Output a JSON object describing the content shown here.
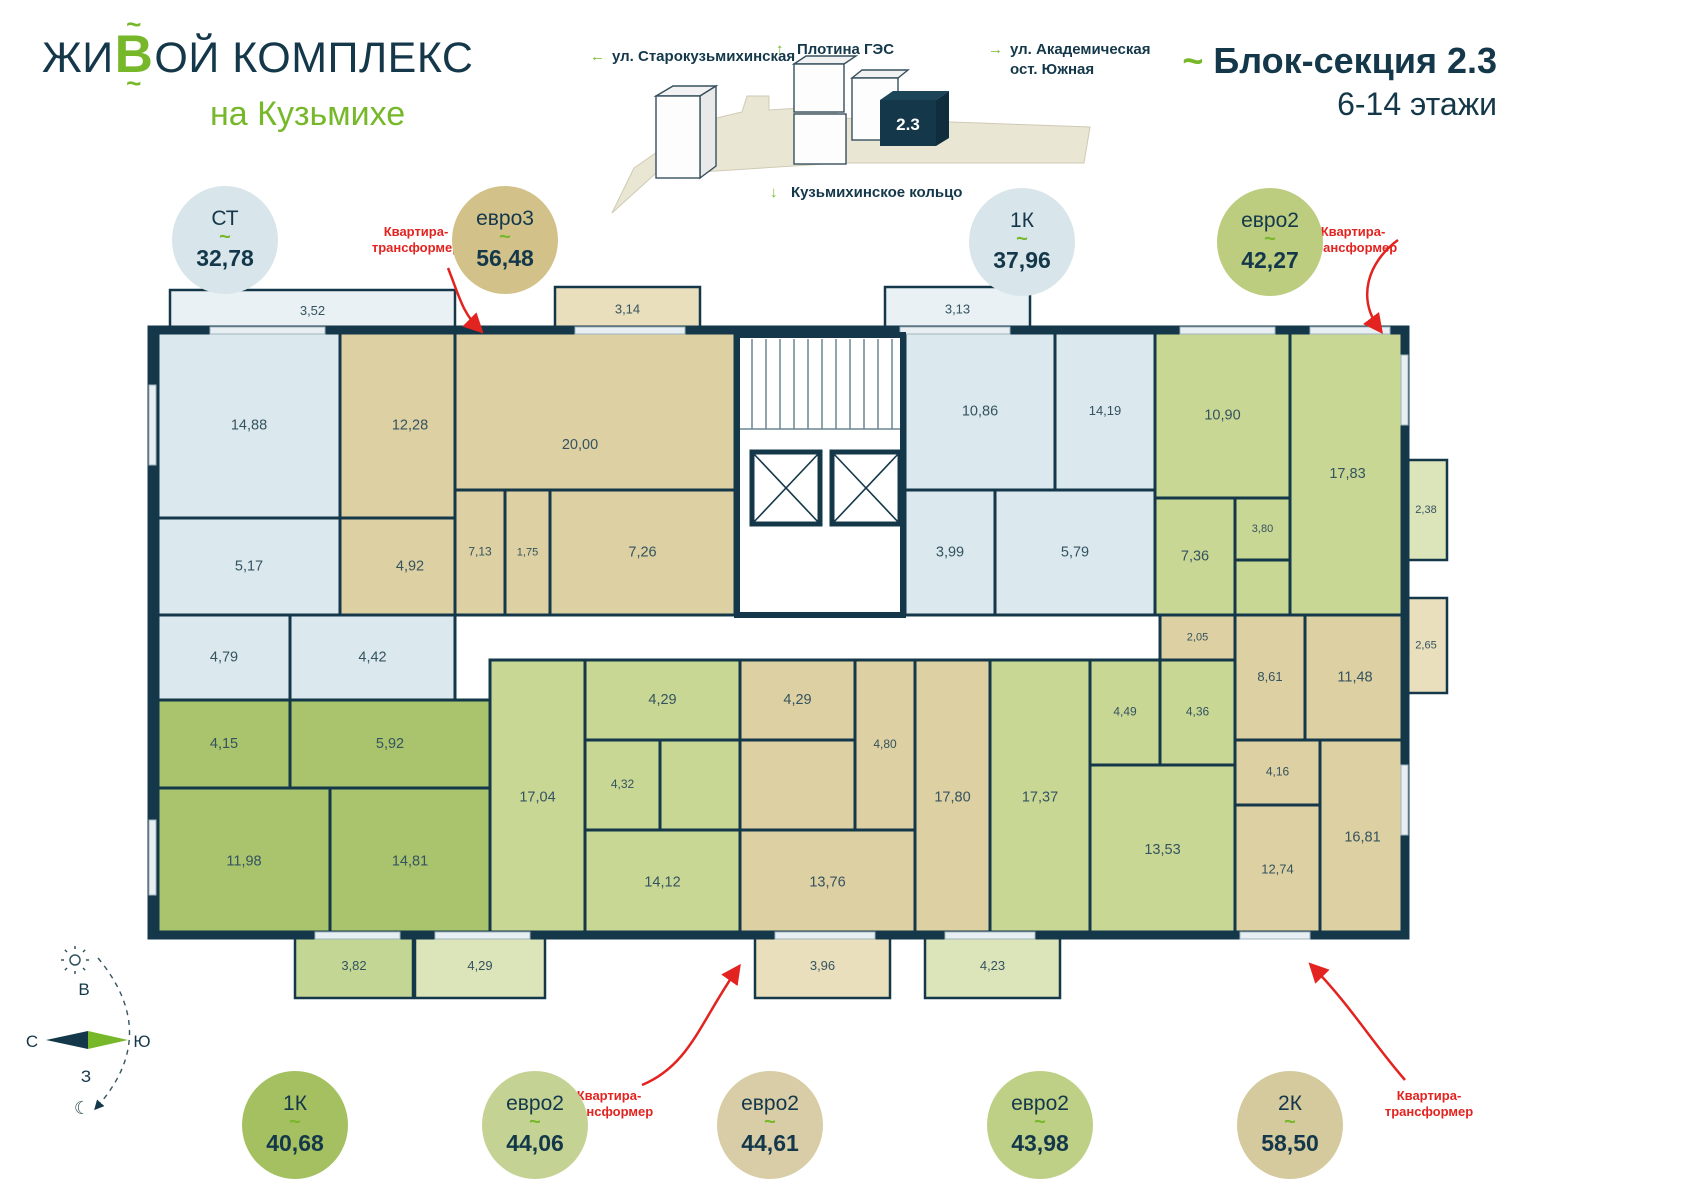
{
  "header": {
    "logo": {
      "part1": "жи",
      "accent": "В",
      "part2": "ой комплекс",
      "tilde": "~",
      "subtitle": "на Кузьмихе"
    },
    "title": {
      "tilde": "~",
      "line1": "Блок-секция 2.3",
      "line2": "6-14 этажи"
    },
    "site_map": {
      "block_label": "2.3",
      "labels": [
        {
          "arrow": "←",
          "line1": "ул. Старокузьмихинская",
          "line2": ""
        },
        {
          "arrow": "↑",
          "line1": "Плотина ГЭС",
          "line2": ""
        },
        {
          "arrow": "→",
          "line1": "ул. Академическая",
          "line2": "ост. Южная"
        },
        {
          "arrow": "↓",
          "line1": "Кузьмихинское кольцо",
          "line2": ""
        }
      ]
    }
  },
  "badges": {
    "tilde": "~",
    "transformer_label": "Квартира-трансформер",
    "list": [
      {
        "type": "СТ",
        "area": "32,78",
        "color": "#d8e6ec",
        "x": 225,
        "y": 240
      },
      {
        "type": "евро3",
        "area": "56,48",
        "color": "#d2c28a",
        "x": 505,
        "y": 240
      },
      {
        "type": "1К",
        "area": "37,96",
        "color": "#d8e6ec",
        "x": 1022,
        "y": 242
      },
      {
        "type": "евро2",
        "area": "42,27",
        "color": "#bccd80",
        "x": 1270,
        "y": 242
      },
      {
        "type": "1К",
        "area": "40,68",
        "color": "#a5c061",
        "x": 295,
        "y": 1125
      },
      {
        "type": "евро2",
        "area": "44,06",
        "color": "#c4d394",
        "x": 535,
        "y": 1125
      },
      {
        "type": "евро2",
        "area": "44,61",
        "color": "#d8cda6",
        "x": 770,
        "y": 1125
      },
      {
        "type": "евро2",
        "area": "43,98",
        "color": "#bed086",
        "x": 1040,
        "y": 1125
      },
      {
        "type": "2К",
        "area": "58,50",
        "color": "#d5c99e",
        "x": 1290,
        "y": 1125
      }
    ]
  },
  "compass": {
    "north": "С",
    "south": "Ю",
    "east": "В",
    "west": "З",
    "moon": "☾"
  },
  "floorplan": {
    "palette": {
      "wall": "#14384a",
      "label": "#35535f",
      "blue": "#dbe9ef",
      "blue_bal": "#e9f1f5",
      "tan": "#ddd0a2",
      "tan_bal": "#eadfbd",
      "green": "#c9d795",
      "green_bal": "#dce4ba",
      "dgreen": "#a9c46c",
      "dgreen_bal": "#c3d694"
    },
    "apartments": [
      {
        "type": "СТ",
        "total": "32,78",
        "color": "blue",
        "rooms": [
          {
            "l": "14,88",
            "x": 158,
            "y": 333,
            "w": 182,
            "h": 185
          },
          {
            "l": "5,17",
            "x": 158,
            "y": 518,
            "w": 182,
            "h": 97
          },
          {
            "l": "4,79",
            "x": 158,
            "y": 615,
            "w": 132,
            "h": 85
          },
          {
            "l": "4,42",
            "x": 290,
            "y": 615,
            "w": 165,
            "h": 85
          }
        ],
        "balconies": [
          {
            "l": "3,52",
            "x": 170,
            "y": 290,
            "w": 285,
            "h": 43
          }
        ]
      },
      {
        "type": "евро3",
        "total": "56,48",
        "color": "tan",
        "rooms": [
          {
            "l": "12,28",
            "x": 340,
            "y": 333,
            "w": 140,
            "h": 185
          },
          {
            "l": "4,92",
            "x": 340,
            "y": 518,
            "w": 140,
            "h": 97
          },
          {
            "l": "20,00",
            "x": 455,
            "y": 333,
            "w": 280,
            "h": 157,
            "lx": 580,
            "ly": 445
          },
          {
            "l": "7,13",
            "x": 455,
            "y": 490,
            "w": 50,
            "h": 125,
            "fs": 12
          },
          {
            "l": "1,75",
            "x": 505,
            "y": 490,
            "w": 45,
            "h": 125,
            "fs": 11
          },
          {
            "l": "7,26",
            "x": 550,
            "y": 490,
            "w": 185,
            "h": 125
          }
        ],
        "balconies": [
          {
            "l": "3,14",
            "x": 555,
            "y": 287,
            "w": 145,
            "h": 46
          }
        ]
      },
      {
        "type": "1К",
        "total": "37,96",
        "color": "blue",
        "rooms": [
          {
            "l": "10,86",
            "x": 905,
            "y": 333,
            "w": 150,
            "h": 157
          },
          {
            "l": "14,19",
            "x": 1055,
            "y": 333,
            "w": 100,
            "h": 157,
            "fs": 13
          },
          {
            "l": "3,99",
            "x": 905,
            "y": 490,
            "w": 90,
            "h": 125
          },
          {
            "l": "5,79",
            "x": 995,
            "y": 490,
            "w": 160,
            "h": 125
          }
        ],
        "balconies": [
          {
            "l": "3,13",
            "x": 885,
            "y": 287,
            "w": 145,
            "h": 46
          }
        ]
      },
      {
        "type": "евро2",
        "total": "42,27",
        "color": "green",
        "rooms": [
          {
            "l": "10,90",
            "x": 1155,
            "y": 333,
            "w": 135,
            "h": 165
          },
          {
            "l": "17,83",
            "x": 1290,
            "y": 333,
            "w": 115,
            "h": 282
          },
          {
            "l": "7,36",
            "x": 1155,
            "y": 498,
            "w": 80,
            "h": 117
          },
          {
            "l": "3,80",
            "x": 1235,
            "y": 498,
            "w": 55,
            "h": 62,
            "fs": 11
          },
          {
            "l": "",
            "x": 1235,
            "y": 560,
            "w": 55,
            "h": 55
          }
        ],
        "balconies": [
          {
            "l": "2,38",
            "x": 1405,
            "y": 460,
            "w": 42,
            "h": 100,
            "fs": 11
          }
        ]
      },
      {
        "type": "2К",
        "total": "58,50",
        "color": "tan",
        "rooms": [
          {
            "l": "2,05",
            "x": 1160,
            "y": 615,
            "w": 75,
            "h": 45,
            "fs": 11
          },
          {
            "l": "8,61",
            "x": 1235,
            "y": 615,
            "w": 70,
            "h": 125,
            "fs": 13
          },
          {
            "l": "11,48",
            "x": 1305,
            "y": 615,
            "w": 100,
            "h": 125
          },
          {
            "l": "4,16",
            "x": 1235,
            "y": 740,
            "w": 85,
            "h": 65,
            "fs": 12
          },
          {
            "l": "12,74",
            "x": 1235,
            "y": 805,
            "w": 85,
            "h": 130,
            "fs": 13
          },
          {
            "l": "16,81",
            "x": 1320,
            "y": 740,
            "w": 85,
            "h": 195
          }
        ],
        "balconies": [
          {
            "l": "2,65",
            "x": 1405,
            "y": 598,
            "w": 42,
            "h": 95,
            "fs": 11
          }
        ]
      },
      {
        "type": "1К",
        "total": "40,68",
        "color": "dgreen",
        "rooms": [
          {
            "l": "4,15",
            "x": 158,
            "y": 700,
            "w": 132,
            "h": 88
          },
          {
            "l": "5,92",
            "x": 290,
            "y": 700,
            "w": 200,
            "h": 88
          },
          {
            "l": "11,98",
            "x": 158,
            "y": 788,
            "w": 172,
            "h": 147
          },
          {
            "l": "14,81",
            "x": 330,
            "y": 788,
            "w": 160,
            "h": 147
          }
        ],
        "balconies": [
          {
            "l": "3,82",
            "x": 295,
            "y": 935,
            "w": 118,
            "h": 63
          }
        ]
      },
      {
        "type": "евро2",
        "total": "44,06",
        "color": "green",
        "rooms": [
          {
            "l": "17,04",
            "x": 490,
            "y": 660,
            "w": 95,
            "h": 275
          },
          {
            "l": "4,29",
            "x": 585,
            "y": 660,
            "w": 155,
            "h": 80
          },
          {
            "l": "4,32",
            "x": 585,
            "y": 740,
            "w": 75,
            "h": 90,
            "fs": 12
          },
          {
            "l": "",
            "x": 660,
            "y": 740,
            "w": 80,
            "h": 90
          },
          {
            "l": "14,12",
            "x": 585,
            "y": 830,
            "w": 155,
            "h": 105
          }
        ],
        "balconies": [
          {
            "l": "4,29",
            "x": 415,
            "y": 935,
            "w": 130,
            "h": 63
          }
        ]
      },
      {
        "type": "евро2",
        "total": "44,61",
        "color": "tan",
        "rooms": [
          {
            "l": "4,29",
            "x": 740,
            "y": 660,
            "w": 115,
            "h": 80
          },
          {
            "l": "4,80",
            "x": 855,
            "y": 660,
            "w": 60,
            "h": 170,
            "fs": 12
          },
          {
            "l": "",
            "x": 740,
            "y": 740,
            "w": 115,
            "h": 90
          },
          {
            "l": "13,76",
            "x": 740,
            "y": 830,
            "w": 175,
            "h": 105
          },
          {
            "l": "17,80",
            "x": 915,
            "y": 660,
            "w": 75,
            "h": 275
          }
        ],
        "balconies": [
          {
            "l": "3,96",
            "x": 755,
            "y": 935,
            "w": 135,
            "h": 63
          }
        ]
      },
      {
        "type": "евро2",
        "total": "43,98",
        "color": "green",
        "rooms": [
          {
            "l": "17,37",
            "x": 990,
            "y": 660,
            "w": 100,
            "h": 275
          },
          {
            "l": "4,49",
            "x": 1090,
            "y": 660,
            "w": 70,
            "h": 105,
            "fs": 12
          },
          {
            "l": "4,36",
            "x": 1160,
            "y": 660,
            "w": 75,
            "h": 105,
            "fs": 12
          },
          {
            "l": "13,53",
            "x": 1090,
            "y": 765,
            "w": 145,
            "h": 170
          }
        ],
        "balconies": [
          {
            "l": "4,23",
            "x": 925,
            "y": 935,
            "w": 135,
            "h": 63
          }
        ]
      }
    ]
  }
}
